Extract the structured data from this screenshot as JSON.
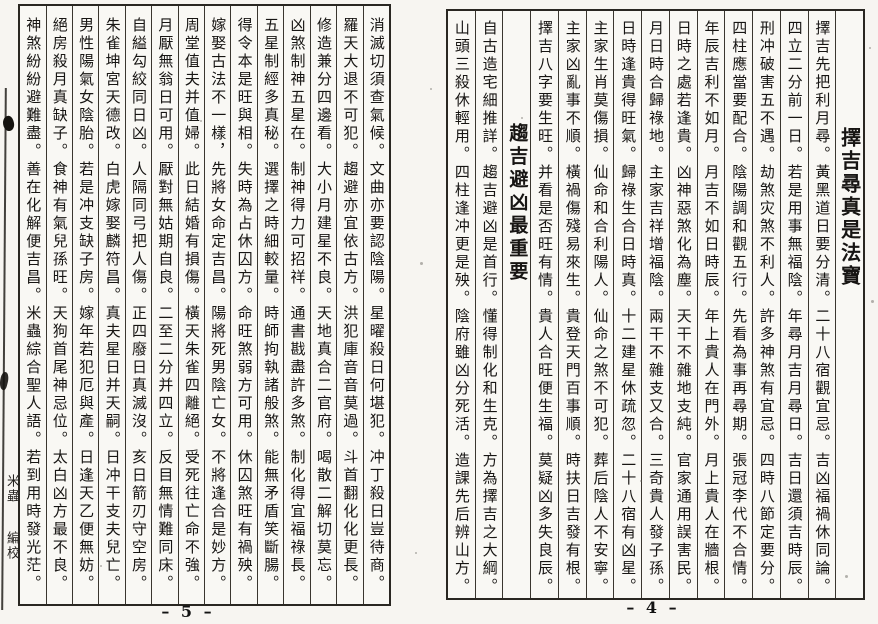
{
  "meta": {
    "description": "Scanned spread (pages 4-5) of a Chinese date-selection verse book, vertical text read right to left",
    "paper_color": "#f7f5f1",
    "ink_color": "#171513"
  },
  "right_page": {
    "page_number": "– 4 –",
    "columns": [
      {
        "type": "title",
        "text": "擇吉尋真是法寶"
      },
      {
        "type": "body",
        "text": "擇吉先把利月尋。黃黑道日要分清。二十八宿觀宜忌。吉凶福禍休同論。"
      },
      {
        "type": "body",
        "text": "四立二分前一日。若是用事無福陰。年尋月吉月尋日。吉日還須吉時辰。"
      },
      {
        "type": "body",
        "text": "刑冲破害五不遇。劫煞灾煞不利人。許多神煞有宜忌。四時八節定要分。"
      },
      {
        "type": "body",
        "text": "四柱應當要配合。陰陽調和觀五行。先看為事再尋期。張冠李代不合情。"
      },
      {
        "type": "body",
        "text": "年辰吉利不如月。月吉不如日時辰。年上貴人在門外。月上貴人在牆根。"
      },
      {
        "type": "body",
        "text": "日時之處若逢貴。凶神惡煞化為塵。天干不雜地支純。官家通用誤害民。"
      },
      {
        "type": "body",
        "text": "月日時合歸祿地。主家吉祥增福陰。兩干不雜支又合。三奇貴人發子孫。"
      },
      {
        "type": "body",
        "text": "日時逢貴得旺氣。歸祿生合日時真。十二建星休疏忽。二十八宿有凶星。"
      },
      {
        "type": "body",
        "text": "主家生肖莫傷損。仙命和合利陽人。仙命之煞不可犯。葬后陰人不安寧。"
      },
      {
        "type": "body",
        "text": "主家凶亂事不順。橫禍傷殘易來生。貴登天門百事順。時扶日吉發有根。"
      },
      {
        "type": "body",
        "text": "擇吉八字要生旺。并看是否旺有情。貴人合旺便生福。莫疑凶多失良辰。"
      },
      {
        "type": "header",
        "text": "趨吉避凶最重要"
      },
      {
        "type": "body",
        "text": "自古造宅細推詳。趨吉避凶是首行。懂得制化和生克。方為擇吉之大綱。"
      },
      {
        "type": "body",
        "text": "山頭三殺休輕用。四柱逢冲更是殃。陰府雖凶分死活。造課先后辨山方。"
      }
    ]
  },
  "left_page": {
    "page_number": "– 5 –",
    "margin_colophon": [
      "米蟲",
      "編校"
    ],
    "columns": [
      {
        "type": "body",
        "text": "消滅切須查氣候。文曲亦要認陰陽。星曜殺日何堪犯。冲丁殺日豈待商。"
      },
      {
        "type": "body",
        "text": "羅天大退不可犯。趨避亦宜依古方。洪犯庫音音莫過。斗首翻化化更長。"
      },
      {
        "type": "body",
        "text": "修造兼分四邊看。大小月建星不良。天地真合二官府。喝散二解切莫忘。"
      },
      {
        "type": "body",
        "text": "凶煞制神五星在。制神得力可招祥。通書戡盡許多煞。制化得宜福祿長。"
      },
      {
        "type": "body",
        "text": "五星制經多真秘。選擇之時細較量。時師拘執諸般煞。能無矛盾笑斷腸。"
      },
      {
        "type": "body",
        "text": "得令本是旺與相。失時為占休囚方。命旺煞弱方可用。休囚煞旺有禍殃。"
      },
      {
        "type": "body",
        "text": "嫁娶古法不一樣，先將女命定吉昌。陽將死男陰亡女。不將逢合是妙方。"
      },
      {
        "type": "body",
        "text": "周堂值夫并值婦。此日結婚有損傷。橫天朱雀四離絕。受死往亡命不強。"
      },
      {
        "type": "body",
        "text": "月厭無翁日可用。厭對無姑期自良。二至二分并四立。反目無情難同床。"
      },
      {
        "type": "body",
        "text": "自縊勾絞同日凶。人隔同弓把人傷。正四廢日真滅沒。亥日箭刃守空房。"
      },
      {
        "type": "body",
        "text": "朱雀坤宮天德改。白虎嫁娶麟符昌。真夫星日并天嗣。日冲干支夫兒亡。"
      },
      {
        "type": "body",
        "text": "男性陽氣女陰胎。若是冲支缺子房。嫁年若犯厄與產。日逢天乙便無妨。"
      },
      {
        "type": "body",
        "text": "絕房殺月真缺子。食神有氣兒孫旺。天狗首尾神忌位。太白凶方最不良。"
      },
      {
        "type": "body",
        "text": "神煞紛紛避難盡。善在化解便吉昌。米蟲綜合聖人語。若到用時發光茫。"
      }
    ]
  }
}
